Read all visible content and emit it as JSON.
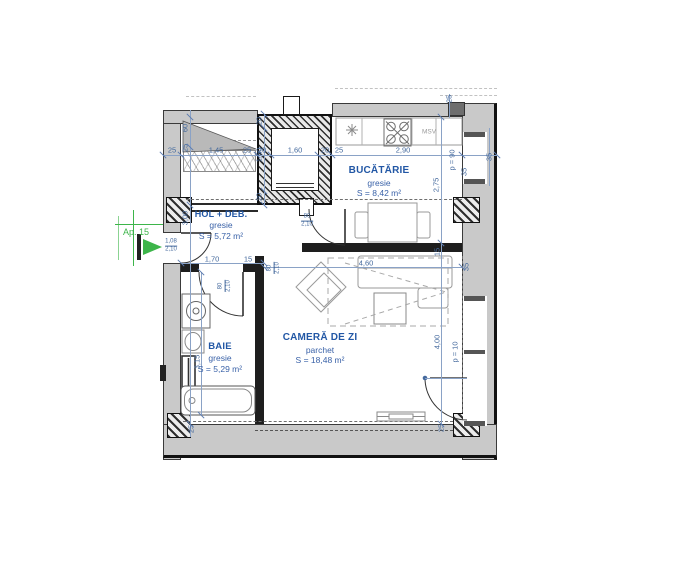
{
  "entrance": {
    "label": "Ap. 15"
  },
  "rooms": [
    {
      "name": "BUCĂTĂRIE",
      "finish": "gresie",
      "area": "S = 8,42 m²"
    },
    {
      "name": "HOL + DEB.",
      "finish": "gresie",
      "area": "S = 5,72 m²"
    },
    {
      "name": "BAIE",
      "finish": "gresie",
      "area": "S = 5,29 m²"
    },
    {
      "name": "CAMERĂ DE ZI",
      "finish": "parchet",
      "area": "S = 18,48 m²"
    }
  ],
  "appliances": {
    "dishwasher": "MSV"
  },
  "colors": {
    "dimension": "#44699d",
    "room_label": "#2257a5",
    "entrance_green": "#3db54a",
    "wall_gray": "#c9c9c9"
  },
  "dim_labels": [
    {
      "t": "25",
      "x": 172,
      "y": 150,
      "r": 0
    },
    {
      "t": "1,45",
      "x": 216,
      "y": 150,
      "r": 0
    },
    {
      "t": "25",
      "x": 247,
      "y": 150,
      "r": 0
    },
    {
      "t": "20",
      "x": 262,
      "y": 150,
      "r": 0
    },
    {
      "t": "1,60",
      "x": 295,
      "y": 150,
      "r": 0
    },
    {
      "t": "20",
      "x": 325,
      "y": 150,
      "r": 0
    },
    {
      "t": "25",
      "x": 339,
      "y": 150,
      "r": 0
    },
    {
      "t": "2,90",
      "x": 403,
      "y": 150,
      "r": 0
    },
    {
      "t": "35",
      "x": 489,
      "y": 157,
      "r": 1
    },
    {
      "t": "25",
      "x": 449,
      "y": 99,
      "r": 1
    },
    {
      "t": "60",
      "x": 185,
      "y": 128,
      "r": 1
    },
    {
      "t": "25",
      "x": 185,
      "y": 148,
      "r": 1
    },
    {
      "t": "3,00",
      "x": 185,
      "y": 218,
      "r": 1
    },
    {
      "t": "3,15",
      "x": 197,
      "y": 362,
      "r": 1
    },
    {
      "t": "25",
      "x": 191,
      "y": 429,
      "r": 1
    },
    {
      "t": "20",
      "x": 259,
      "y": 121,
      "r": 1
    },
    {
      "t": "1,60",
      "x": 259,
      "y": 155,
      "r": 1
    },
    {
      "t": "20",
      "x": 259,
      "y": 197,
      "r": 1
    },
    {
      "t": "2,75",
      "x": 436,
      "y": 185,
      "r": 1
    },
    {
      "t": "p = 90",
      "x": 452,
      "y": 160,
      "r": 1
    },
    {
      "t": "35",
      "x": 464,
      "y": 172,
      "r": 1
    },
    {
      "t": "15",
      "x": 437,
      "y": 252,
      "r": 1
    },
    {
      "t": "35",
      "x": 466,
      "y": 267,
      "r": 1
    },
    {
      "t": "4,00",
      "x": 437,
      "y": 342,
      "r": 1
    },
    {
      "t": "p = 10",
      "x": 455,
      "y": 352,
      "r": 1
    },
    {
      "t": "25",
      "x": 441,
      "y": 428,
      "r": 1
    },
    {
      "t": "1,70",
      "x": 212,
      "y": 259,
      "r": 0
    },
    {
      "t": "15",
      "x": 248,
      "y": 259,
      "r": 0
    },
    {
      "t": "4,60",
      "x": 366,
      "y": 263,
      "r": 0
    }
  ],
  "door_labels": [
    {
      "top": "1,08",
      "bottom": "2,10",
      "x": 171,
      "y": 246,
      "r": 0
    },
    {
      "top": "80",
      "bottom": "2,10",
      "x": 307,
      "y": 221,
      "r": 0
    },
    {
      "top": "80",
      "bottom": "2,10",
      "x": 225,
      "y": 286,
      "r": 1
    },
    {
      "top": "80",
      "bottom": "2,10",
      "x": 274,
      "y": 268,
      "r": 1
    }
  ]
}
